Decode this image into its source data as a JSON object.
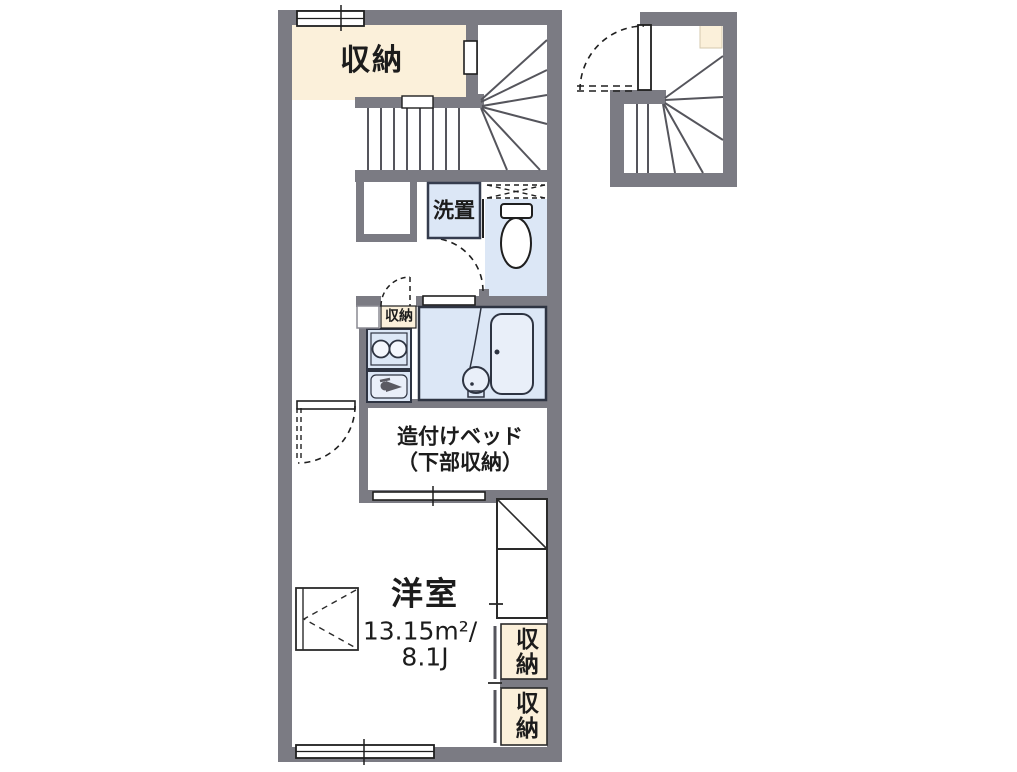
{
  "plan_title": "1R apartment floor plan",
  "colors": {
    "wall": "#7b7b83",
    "closet_beige": "#fbf0da",
    "wet_area_blue": "#dce7f6",
    "fixture_fill": "#e9eff9",
    "line": "#1f1f1f"
  },
  "rooms": {
    "closet_top": {
      "label": "収納"
    },
    "laundry": {
      "label": "洗置"
    },
    "closet_small": {
      "label": "収納"
    },
    "bed": {
      "label_line1": "造付けベッド",
      "label_line2": "（下部収納）"
    },
    "main_room": {
      "label": "洋室",
      "area_sqm": "13.15m²/",
      "area_tatami": "8.1J"
    },
    "storage_right_top": {
      "label": "収納"
    },
    "storage_right_bottom": {
      "label": "収納"
    }
  },
  "icons": {
    "stairs": "winding-staircase",
    "toilet": "toilet-icon",
    "bathtub": "bathtub-icon",
    "wash_basin": "wash-basin-icon",
    "stove": "two-burner-stove-icon",
    "sink": "kitchen-sink-icon",
    "faucet": "faucet-icon",
    "windows": "double-line-window",
    "doors": "swing-door-arc"
  }
}
